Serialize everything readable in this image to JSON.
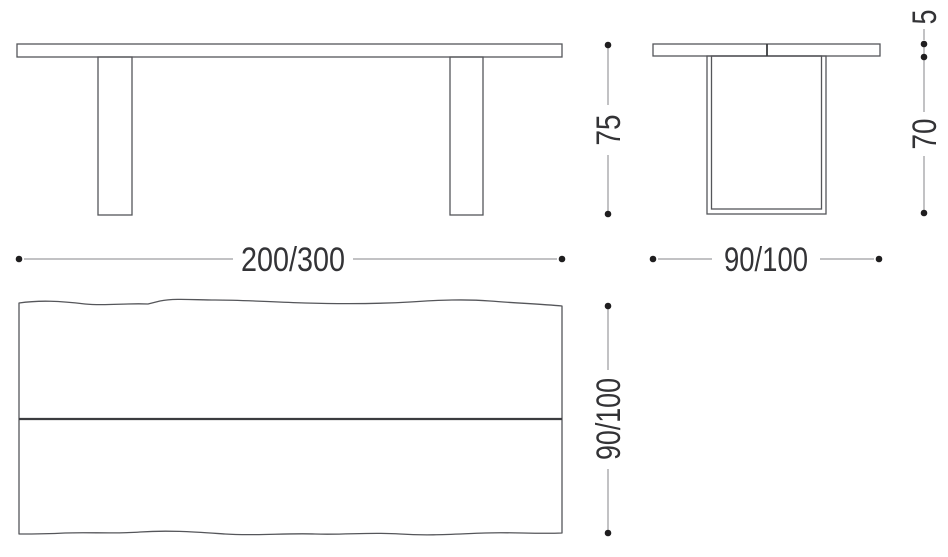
{
  "colors": {
    "outline": "#55565a",
    "heavy_line": "#3b3c3f",
    "dimension_line": "#85868a",
    "dot": "#1f1e1f",
    "text": "#333336"
  },
  "dimensions": {
    "front_width": {
      "label": "200/300"
    },
    "front_height": {
      "label": "75"
    },
    "side_width": {
      "label": "90/100"
    },
    "side_height": {
      "label": "70"
    },
    "tabletop_thickness": {
      "label": "5"
    },
    "top_view_depth": {
      "label": "90/100"
    }
  }
}
